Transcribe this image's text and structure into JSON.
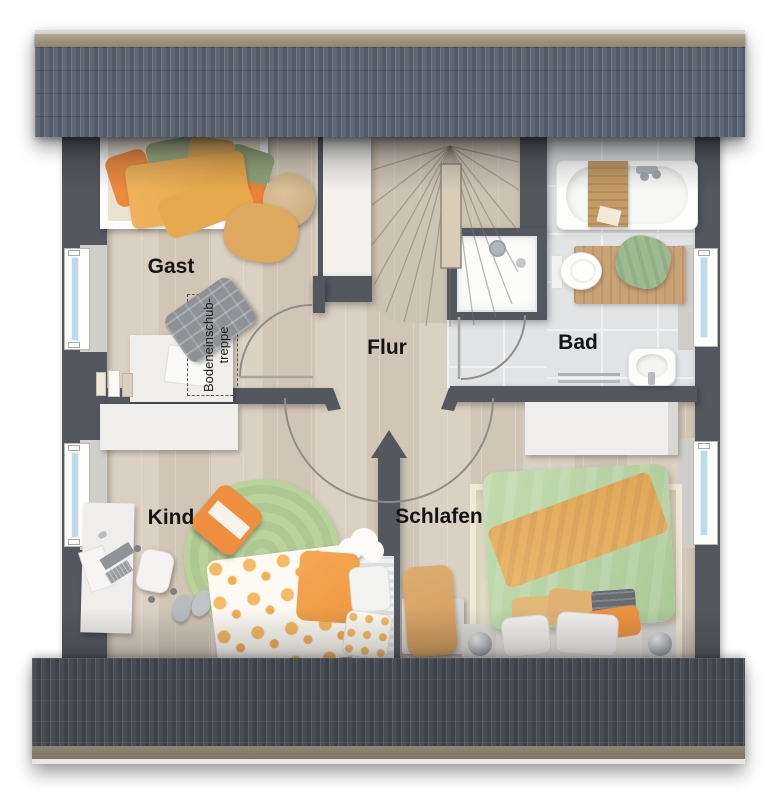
{
  "rooms": [
    {
      "id": "gast",
      "label": "Gast"
    },
    {
      "id": "flur",
      "label": "Flur"
    },
    {
      "id": "bad",
      "label": "Bad"
    },
    {
      "id": "kind",
      "label": "Kind"
    },
    {
      "id": "schlafen",
      "label": "Schlafen"
    }
  ],
  "annotations": {
    "attic_ladder": {
      "line1": "Bodeneinschub-",
      "line2": "treppe"
    }
  },
  "palette": {
    "roof_top": "#57606c",
    "roof_bottom": "#43474e",
    "roof_ridge": "#9a8f79",
    "wall": "#54575e",
    "wood_floor": "#d6cbbc",
    "stair_wood": "#cdc3b3",
    "tile_floor": "#e1e3e5",
    "window_glass": "#bfdae8",
    "accent_orange": "#ee9140",
    "accent_green": "#9aab80",
    "rug_green": "#b7cf99",
    "rug_beige": "#e8e1ca",
    "label_text": "#141414"
  }
}
